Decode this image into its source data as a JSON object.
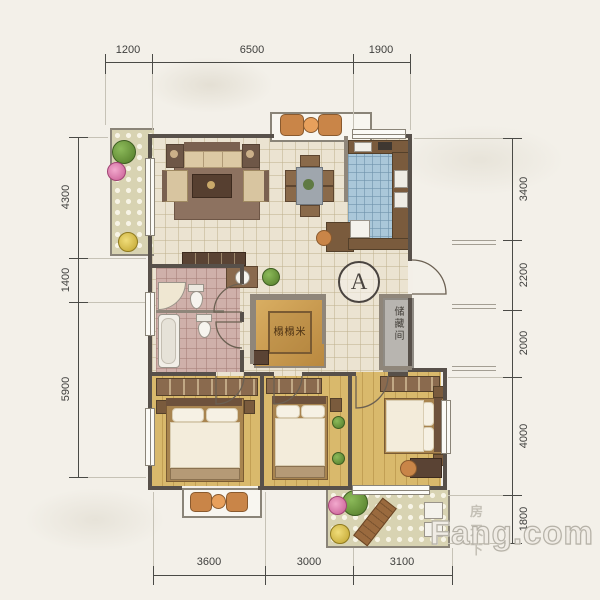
{
  "plan": {
    "type": "residential-floor-plan"
  },
  "dimensions": {
    "top": [
      "1200",
      "6500",
      "1900"
    ],
    "left": [
      "4300",
      "1400",
      "5900"
    ],
    "right": [
      "3400",
      "2200",
      "2000",
      "4000",
      "1800"
    ],
    "bottom": [
      "3600",
      "3000",
      "3100"
    ]
  },
  "labels": {
    "tatami_room": "榻榻米",
    "storage_room": "储藏间",
    "section_marker": "A"
  },
  "watermark": {
    "site_cn": "房天下",
    "site_en": "Fang.com"
  },
  "colors": {
    "paper": "#f3f0e9",
    "wall": "#57504a",
    "hall_tile": "#ebe3d1",
    "kitchen_tile": "#aac7d9",
    "bath_tile": "#cfb0aa",
    "wood_floor": "#d9b96c",
    "balcony_floor": "#d8d3b2",
    "tatami": "#c89a55",
    "storage": "#b8b5b0",
    "sofa_carpet": "#8d7260",
    "accent_chair": "#c98548"
  }
}
